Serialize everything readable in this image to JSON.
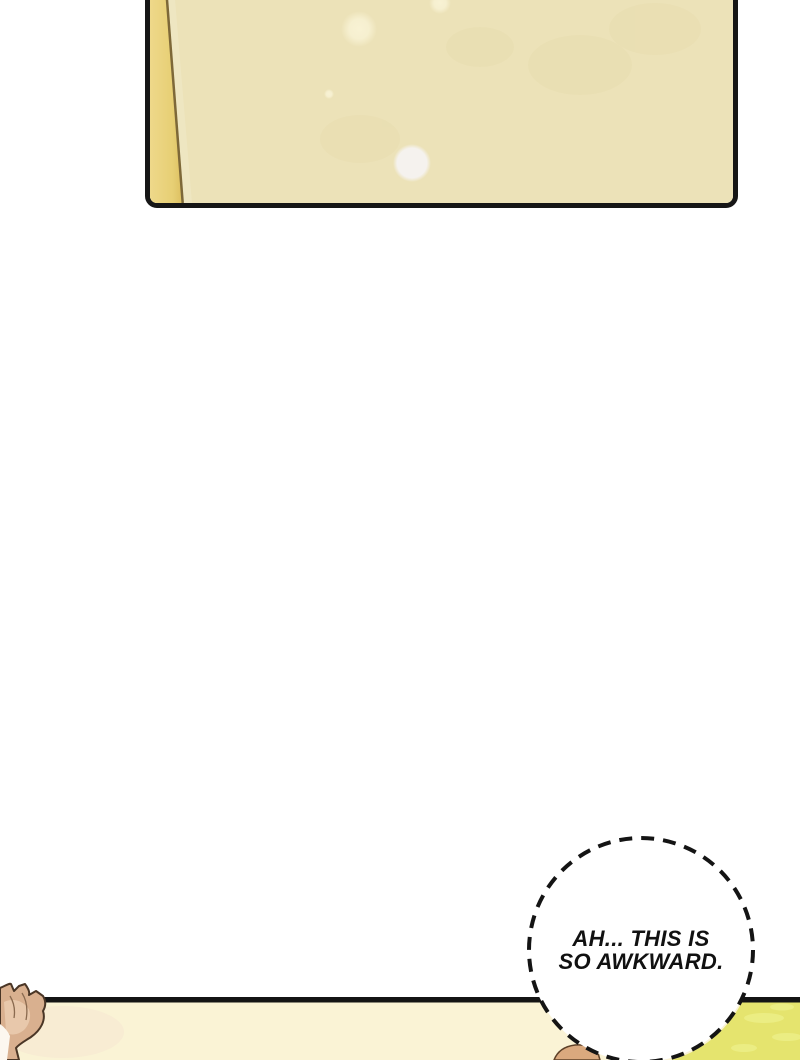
{
  "page": {
    "type": "webtoon-comic-page",
    "background": "#ffffff"
  },
  "top_panel": {
    "surface_color": "#ece2b8",
    "strip_color_light": "#eed88a",
    "strip_color_dark": "#dcbf60",
    "fold_line_color": "#7d6838",
    "border_color": "#161616",
    "soft_spot_color": "#f8f2d4",
    "bright_spot_color": "#f5f2ee",
    "mottle_color": "#e2d6a2"
  },
  "bottom_panel": {
    "border_color": "#141414",
    "floor_color": "#faf3d5",
    "warm_tint_color": "#f5e3cf",
    "grass_color": "#e5e46e",
    "grass_highlight_color": "#eef08a",
    "hair_fill_color": "#d9b08f",
    "hair_highlight_color": "#ecd0b4",
    "hair_outline_color": "#4a3626",
    "hair_strand_line_color": "#8a6a4f",
    "pale_corner_color": "#fcf7ef",
    "head_fill_color": "#daa97e",
    "head_outline_color": "#5d4027"
  },
  "speech_bubble": {
    "fill": "#ffffff",
    "border_color": "#141414",
    "border_style": "dashed",
    "text_color": "#111111",
    "lines": [
      "AH... THIS IS",
      "SO AWKWARD."
    ]
  }
}
